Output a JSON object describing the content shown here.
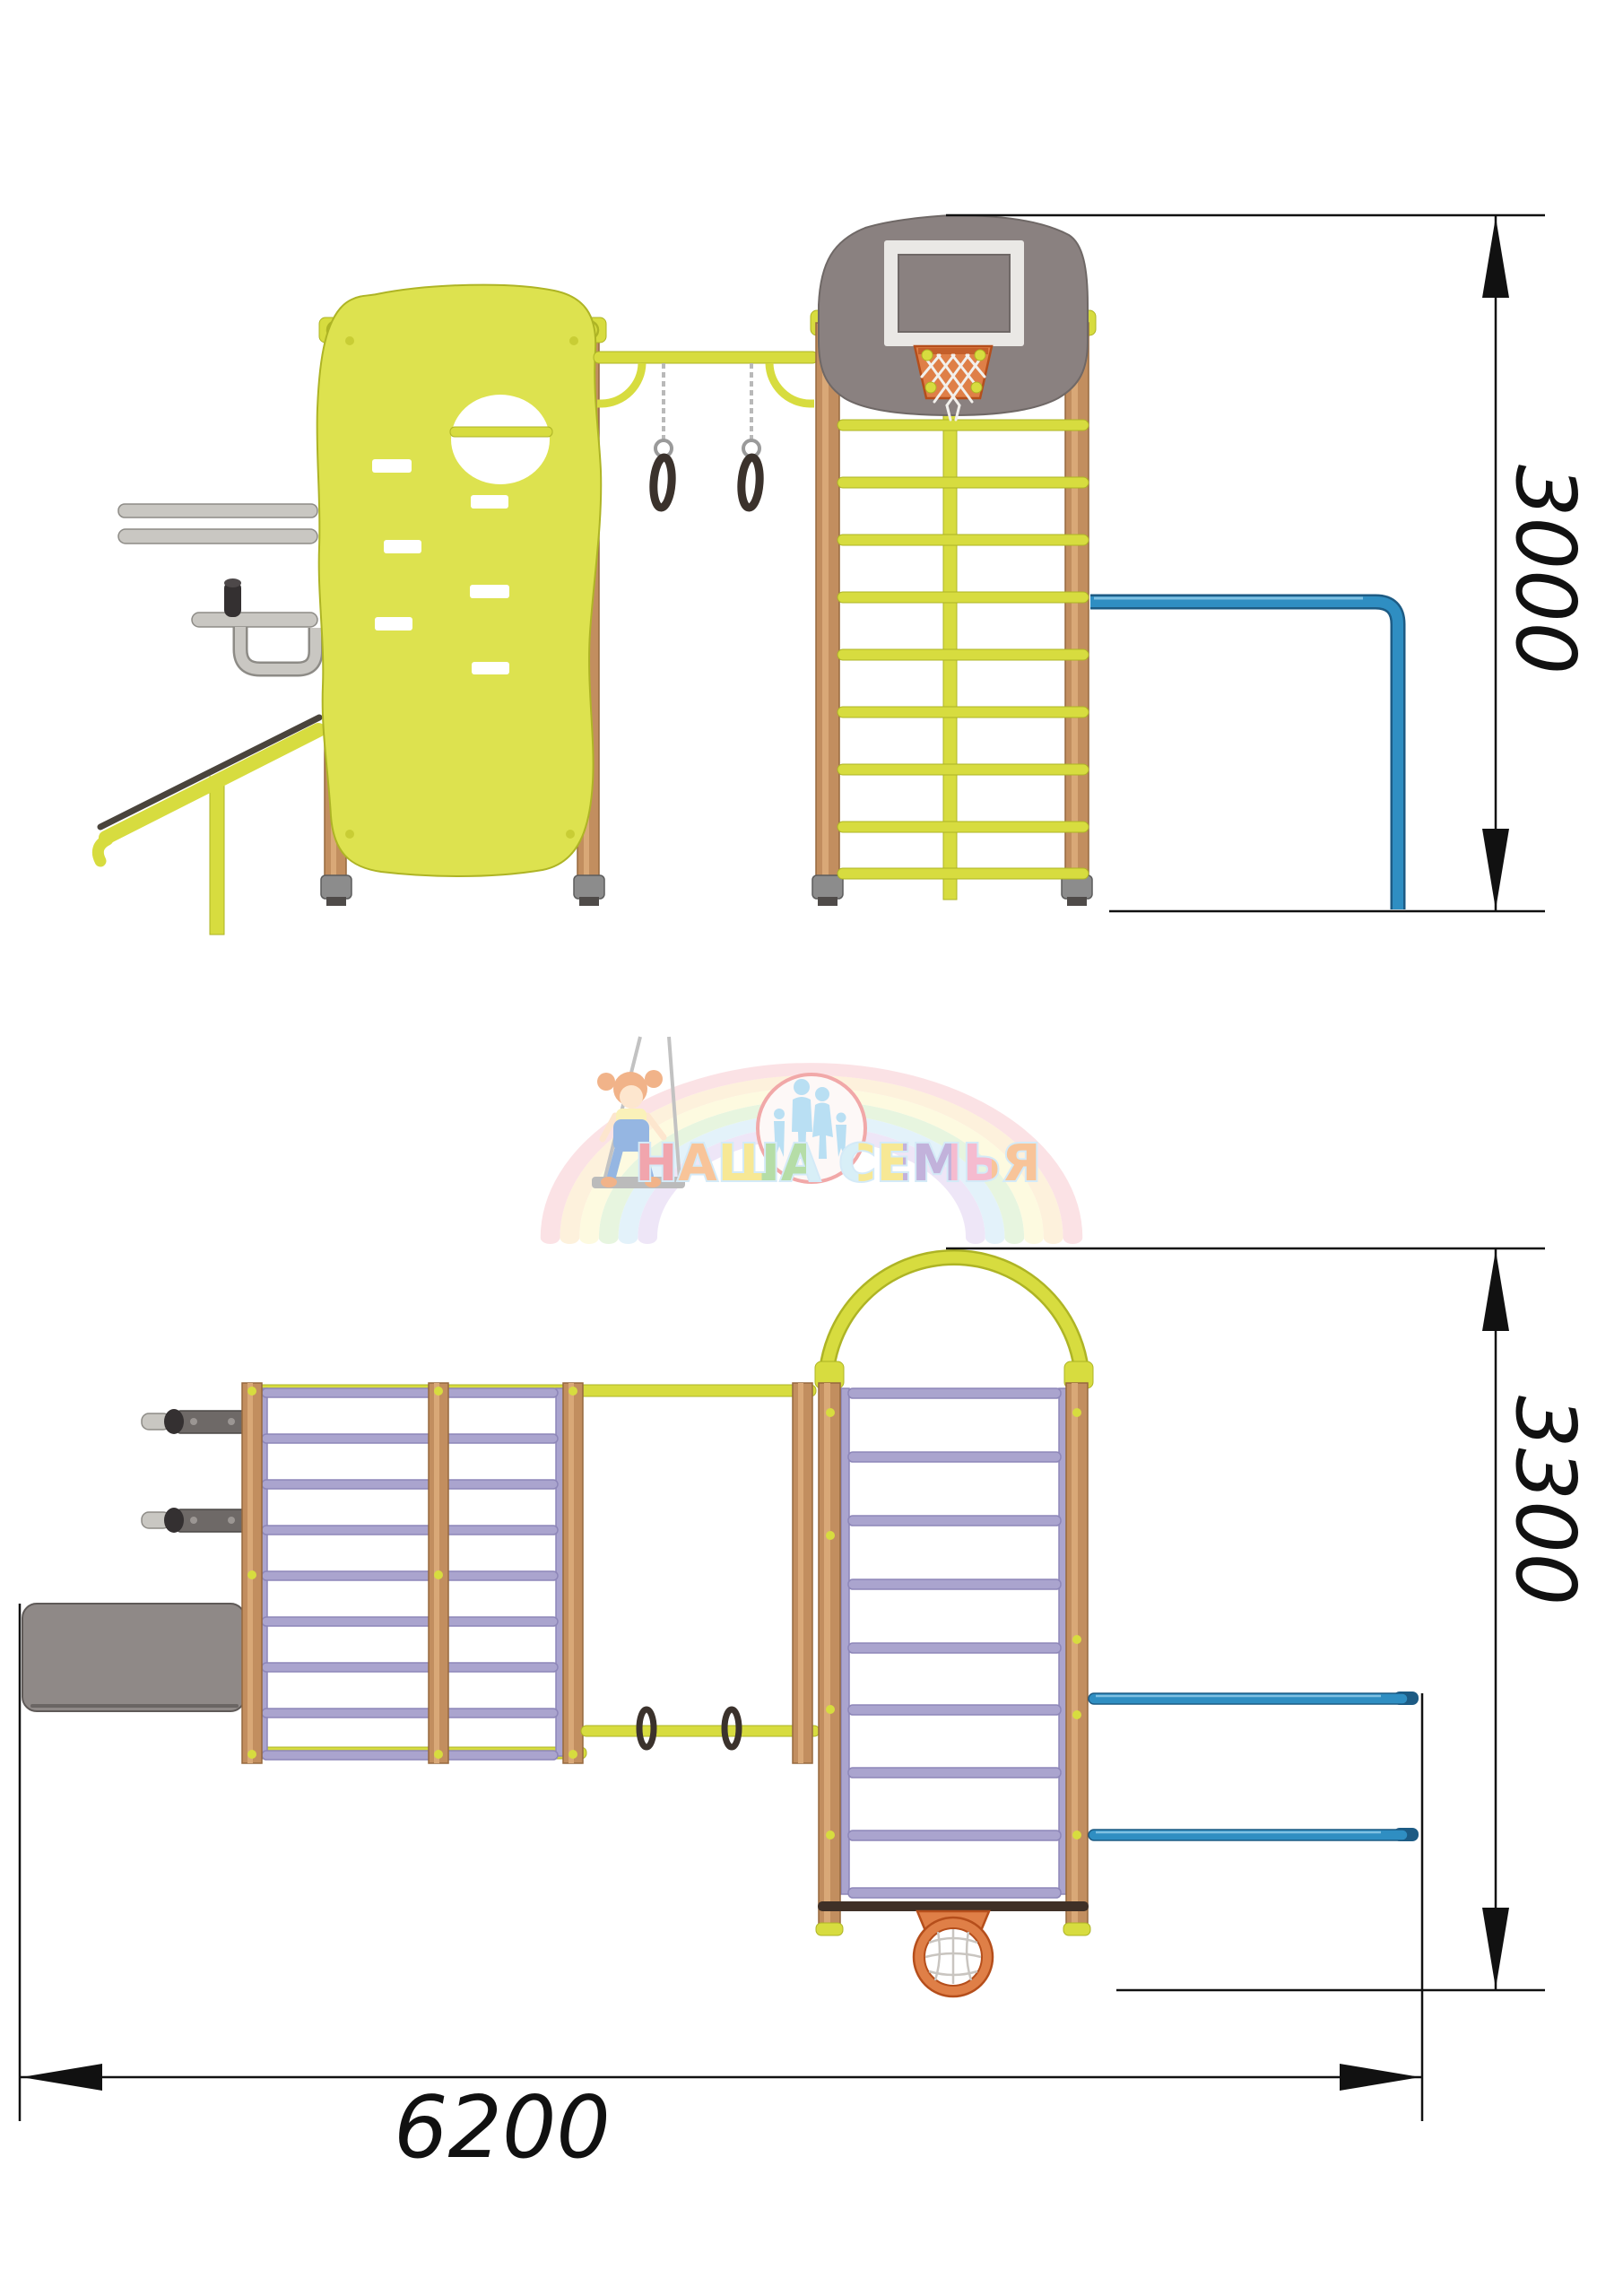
{
  "drawing": {
    "side_view": {
      "height_label": "3000"
    },
    "plan_view": {
      "depth_label": "3300",
      "width_label": "6200"
    }
  },
  "watermark": {
    "brand": "НАША СЕМЬЯ"
  },
  "palette": {
    "structure_yellow": "#d7dc3f",
    "structure_yellow_dark": "#aeb425",
    "wall_yellow": "#dde24f",
    "post_brown": "#c28e5f",
    "post_brown_light": "#d9a877",
    "post_brown_dark": "#96683f",
    "rung_lavender": "#aaa4ce",
    "rung_lavender_dark": "#8d86b8",
    "bar_blue": "#2f8ec2",
    "bar_blue_dark": "#1d5b84",
    "backboard_grey": "#8a8180",
    "backboard_white": "#eae8e5",
    "hoop_orange": "#df7f47",
    "hoop_orange_dark": "#b54e1b",
    "panel_grey": "#8f8987",
    "bracket_grey": "#6e6967",
    "metal_grey": "#c9c7c2",
    "knob_black": "#343031",
    "ring_dark": "#3b322c",
    "chain_grey": "#b9b9b9",
    "dim_black": "#111111",
    "foot_grey": "#8c8c8c"
  }
}
